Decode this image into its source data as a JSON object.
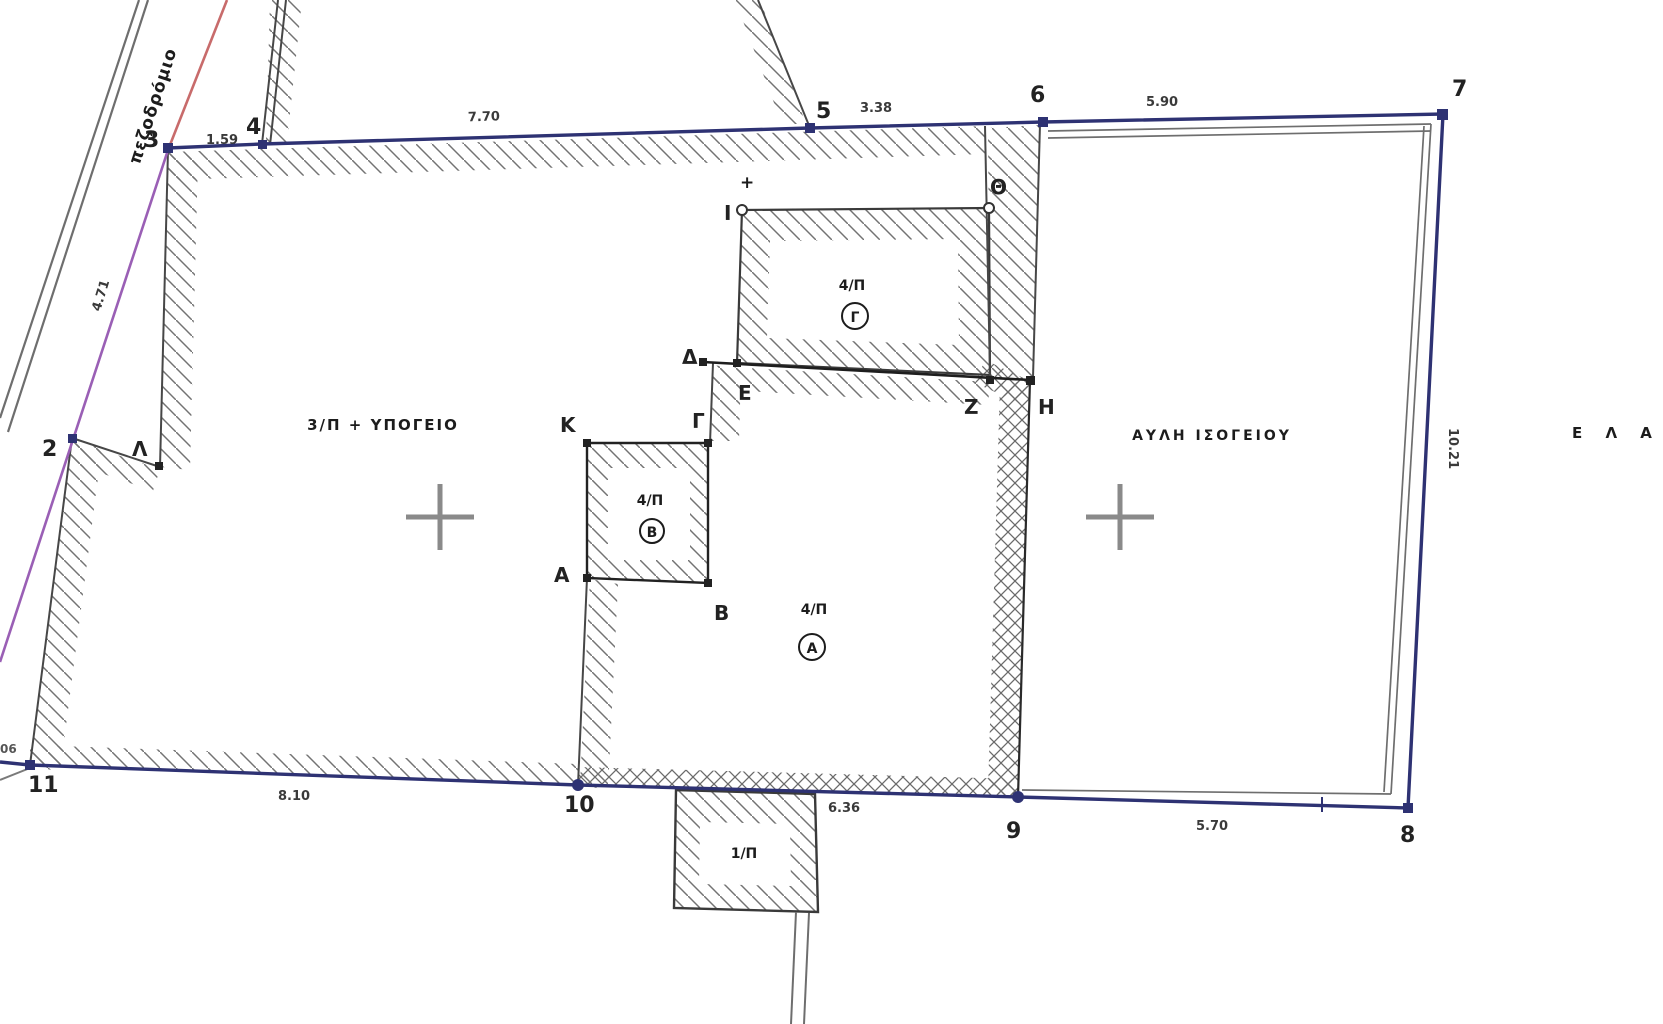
{
  "street": {
    "label": "πεζοδρόμιο"
  },
  "areas": {
    "left_building": "3/Π + ΥΠΟΓΕΙΟ",
    "courtyard": "ΑΥΛΗ ΙΣΟΓΕΙΟΥ",
    "right_partial": "Ε Λ Α Ι"
  },
  "rooms": {
    "gamma": {
      "label": "4/Π",
      "letter": "Γ"
    },
    "beta": {
      "label": "4/Π",
      "letter": "Β"
    },
    "alpha": {
      "label": "4/Π",
      "letter": "Α"
    },
    "bottom": {
      "label": "1/Π"
    }
  },
  "points": {
    "p2": "2",
    "p3": "3",
    "p4": "4",
    "p5": "5",
    "p6": "6",
    "p7": "7",
    "p8": "8",
    "p9": "9",
    "p10": "10",
    "p11": "11",
    "alpha": "Α",
    "beta": "Β",
    "gamma": "Γ",
    "delta": "Δ",
    "epsilon": "Ε",
    "zeta": "Ζ",
    "eta": "Η",
    "theta": "Θ",
    "iota": "Ι",
    "kappa": "Κ",
    "lambda": "Λ",
    "iota_mark": "+"
  },
  "measurements": {
    "m3_4": "1.59",
    "m4_5": "7.70",
    "m5_6": "3.38",
    "m6_7": "5.90",
    "m7_8": "10.21",
    "m8_9": "5.70",
    "m9_10": "6.36",
    "m10_11": "8.10",
    "m2_3": "4.71",
    "edge_left": "06"
  },
  "colors": {
    "boundary": "#2e3273",
    "walls": "#474747",
    "hatch": "#737373",
    "street_red": "#c86b6b",
    "street_purple": "#9a5fb5",
    "inner_gray": "#6e6e6e",
    "cross": "#8a8a8a",
    "text": "#1c1c1c"
  }
}
